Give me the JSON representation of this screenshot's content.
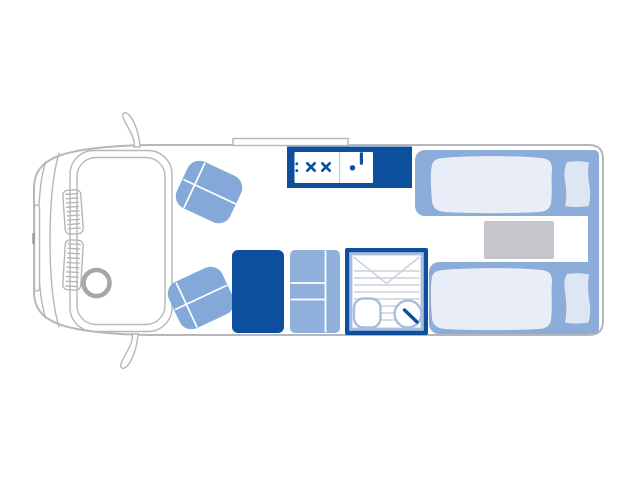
{
  "colors": {
    "accent": "#0e4f9d",
    "seat": "#84a8d8",
    "furniture": "#8fb0da",
    "bed_base": "#8cadd9",
    "duvet": "#e9edf7",
    "pillow": "#dfe6f3",
    "storage": "#c4c6cb",
    "outline": "#b5b7ba",
    "trim": "#a9bedf",
    "line": "#ccd1da",
    "background": "#ffffff"
  },
  "diagram": {
    "type": "floorplan",
    "subject": "motorhome top view layout",
    "zones": [
      {
        "id": "cab",
        "fixtures": [
          "front-bumper",
          "grille-upper",
          "grille-lower",
          "windshield",
          "steering-wheel",
          "side-mirror-top",
          "side-mirror-bottom"
        ]
      },
      {
        "id": "lounge",
        "fixtures": [
          "swivel-seat-front",
          "swivel-seat-rear"
        ]
      },
      {
        "id": "kitchen",
        "fixtures": [
          "worktop-counter",
          "hob-two-burner",
          "sink-with-tap",
          "kitchen-cabinet",
          "wardrobe"
        ]
      },
      {
        "id": "washroom",
        "fixtures": [
          "shower-tray",
          "toilet",
          "washbasin-with-tap"
        ]
      },
      {
        "id": "bedroom",
        "fixtures": [
          "single-bed-top",
          "single-bed-bottom",
          "pillow-top",
          "pillow-bottom",
          "storage-step"
        ]
      },
      {
        "id": "roof",
        "fixtures": [
          "roof-vent"
        ]
      }
    ]
  }
}
